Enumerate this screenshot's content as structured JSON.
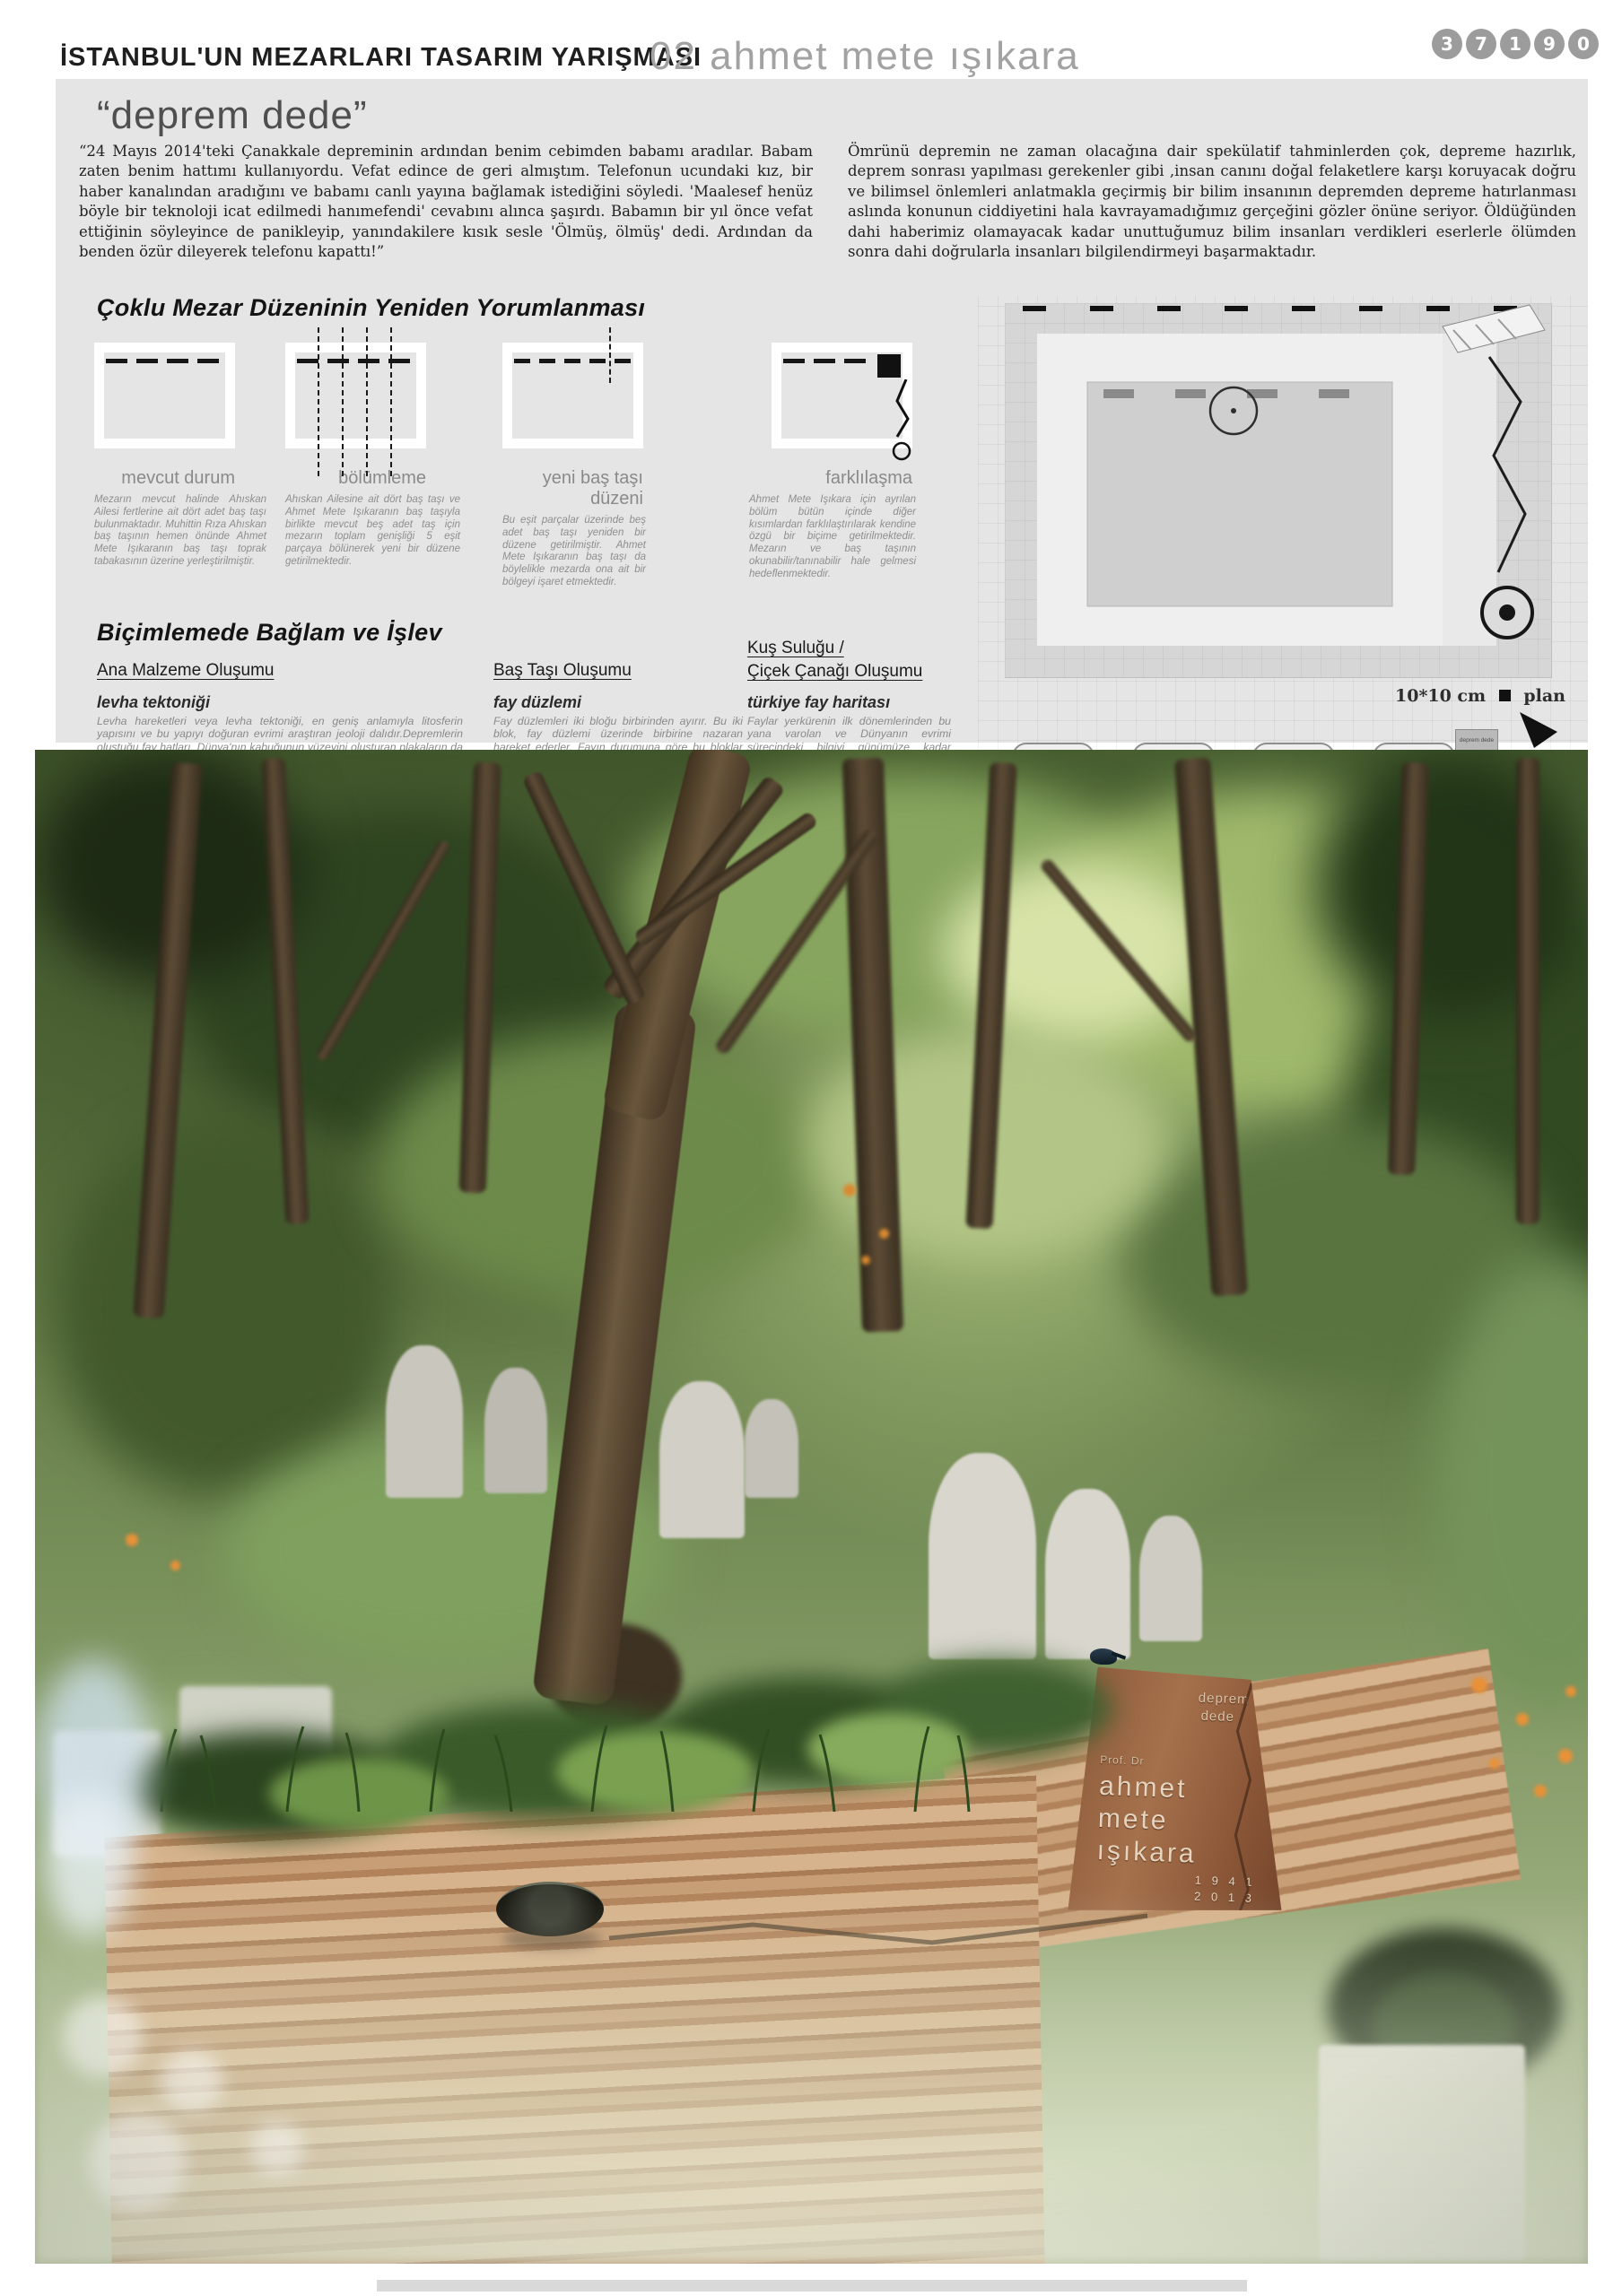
{
  "header": {
    "competition": "İSTANBUL'UN MEZARLARI TASARIM YARIŞMASI",
    "entry": "02 ahmet mete ışıkara",
    "code": [
      "3",
      "7",
      "1",
      "9",
      "0"
    ]
  },
  "quote": {
    "title": "“deprem dede”",
    "left": "“24 Mayıs 2014'teki Çanakkale depreminin ardından benim cebimden babamı aradılar. Babam zaten benim hattımı kullanıyordu. Vefat edince de geri almıştım. Telefonun ucundaki kız, bir haber kanalından aradığını ve babamı canlı yayına bağlamak istediğini söyledi. 'Maalesef henüz böyle bir teknoloji icat edilmedi hanımefendi' cevabını alınca şaşırdı. Babamın bir yıl önce vefat ettiğinin söyleyince de panikleyip, yanındakilere kısık sesle 'Ölmüş, ölmüş' dedi. Ardından da benden özür dileyerek telefonu kapattı!”",
    "right": "Ömrünü depremin ne zaman olacağına dair spekülatif tahminlerden çok, depreme hazırlık, deprem sonrası yapılması gerekenler gibi ,insan canını doğal felaketlere karşı koruyacak doğru ve bilimsel önlemleri anlatmakla geçirmiş bir bilim insanının depremden depreme hatırlanması aslında konunun ciddiyetini hala kavrayamadığımız gerçeğini gözler önüne seriyor. Öldüğünden dahi haberimiz olamayacak kadar unuttuğumuz bilim insanları verdikleri eserlerle ölümden sonra dahi doğrularla insanları bilgilendirmeyi başarmaktadır."
  },
  "reinterp": {
    "title": "Çoklu Mezar Düzeninin Yeniden Yorumlanması",
    "steps": [
      {
        "label": "mevcut durum",
        "text": "Mezarın mevcut halinde Ahıskan Ailesi fertlerine ait dört adet baş taşı bulunmaktadır. Muhittin Rıza Ahıskan baş taşının hemen önünde Ahmet Mete Işıkaranın baş taşı toprak tabakasının üzerine yerleştirilmiştir."
      },
      {
        "label": "bölümleme",
        "text": "Ahıskan Ailesine ait dört baş taşı ve Ahmet Mete Işıkaranın baş taşıyla birlikte mevcut beş adet taş için mezarın toplam genişliği 5 eşit parçaya bölünerek yeni bir düzene getirilmektedir."
      },
      {
        "label": "yeni baş taşı düzeni",
        "text": "Bu eşit parçalar üzerinde beş adet baş taşı yeniden bir düzene getirilmiştir. Ahmet Mete Işıkaranın baş taşı da böylelikle mezarda ona ait bir bölgeyi işaret etmektedir."
      },
      {
        "label": "farklılaşma",
        "text": "Ahmet Mete Işıkara için ayrılan bölüm bütün içinde diğer kısımlardan farklılaştırılarak kendine özgü bir biçime getirilmektedir. Mezarın ve baş taşının okunabilir/tanınabilir hale gelmesi hedeflenmektedir."
      }
    ]
  },
  "drawings": {
    "scale_label": "10*10 cm",
    "plan_label": "plan",
    "front_label": "ön görünüş",
    "side_label": "sağ yan görünüş",
    "stone": {
      "l1": "deprem dede",
      "l2": "ahmet",
      "l3": "mete",
      "l4": "ışıkara",
      "l5": "1941",
      "l6": "2013"
    }
  },
  "form": {
    "title": "Biçimlemede Bağlam ve İşlev",
    "col_a": {
      "header": "Ana Malzeme Oluşumu",
      "items": [
        {
          "title": "levha tektoniği",
          "text": "Levha hareketleri veya levha tektoniği, en geniş anlamıyla litosferin yapısını ve bu yapıyı doğuran evrimi araştıran jeoloji dalıdır.Depremlerin oluştuğu fay hatları, Dünya'nın kabuğunun yüzeyini oluşturan plakaların da sınırlarını belirlemektedir. Yani yer kürenin evrimi boyunca depremler hep var olmuştur ve olacaktır."
        },
        {
          "title": "yapı tektoniği",
          "text": "Mikro ölçekte yer katmanlarının kesitiyle benzerlik taşıyan, yapım tekniği, dayanıklılık, sürdürülebilirlik açısından büyük avantajları olan ve kadim bir yapı yapma yöntemi olarak bilinen sıkıştırılmış toprak yapı yöntemiyle mezar ana strüktürü oluşturulmuştur."
        }
      ],
      "steps": [
        "nemli toprak karışımı (çimento, agrega, kum, kil vs. ) tabakası ile doldurulmuş kontrplak kalıp",
        "kompaktör yardımıyla hacminin yarısına kadar sıkıştırılmış toprak tabakası",
        "tekrar toprak eklenmesi ve aynı işlemlerin sırayla uygulanması",
        "eklenen nemli toprak katmanlarının bir kompaktör yardımıyla tekrar sıkıştırılması",
        "kuruması için yeteri kadar bekledikten sonra kalıplar sökülerek toprak duvar ortaya çıkarılır"
      ]
    },
    "col_b": {
      "header": "Baş Taşı Oluşumu",
      "items": [
        {
          "title": "fay düzlemi",
          "text": "Fay düzlemleri iki bloğu birbirinden ayırır. Bu iki blok, fay düzlemi üzerinde birbirine nazaran hareket ederler. Fayın durumuna göre bu bloklar farklı yönlerde hareket edebilir."
        },
        {
          "title": "kırılma",
          "text": "Mezarın ana gövdesinde oluşan temsili kırılmalar sonucu dikey yönlü oblik fay atımı hareketini referans alan bir hareketle baş taşı oluşmaktadır."
        },
        {
          "title": "baş taşı",
          "text": "Bu dikey hareket diğer mezar taşlarının okunmasını engellemeyecek ve Işıkara'nın mezarının algılanmasını kolaylaştıracak biçimdedir."
        }
      ]
    },
    "col_c": {
      "header1": "Kuş Suluğu /",
      "header2": "Çiçek Çanağı Oluşumu",
      "items": [
        {
          "title": "türkiye fay haritası",
          "text": "Faylar yerkürenin ilk dönemlerinden bu yana varolan ve Dünyanın evrimi sürecindeki bilgiyi günümüze kadar saklayan ve aktaran belleklerdir."
        },
        {
          "title": "yatak/ su yolu",
          "text": "Faylardan ilhamla mezarın gövdesinde açılan yırtıkla oluşturulan su yolu bilgi akışını vurgulamak ve mezarın ana malzemesinin zaman içinde dönüşümüne imkan verecek biçimdedir. Baş taşından başlayan akış Işıkaranın deprem sonrası bilgi aktarımına vurgu yapmaktadır."
        },
        {
          "title": "suluk ve çanak",
          "text": "Su yatağının başlangıcı; baş taşında bulunan bir çanak ve çörtendir. Buradan suyun yatağa akmasıyla çanağa su iletilmektedir. Hem kuşlar için hem de getirilen çiçeklerin sulanması için oluşturulmuştur."
        }
      ]
    }
  },
  "render": {
    "monument": {
      "top1": "deprem",
      "top2": "dede",
      "prefix": "Prof. Dr",
      "name1": "ahmet",
      "name2": "mete",
      "name3": "ışıkara",
      "year1": "1 9 4 1",
      "year2": "2 0 1 3"
    }
  }
}
